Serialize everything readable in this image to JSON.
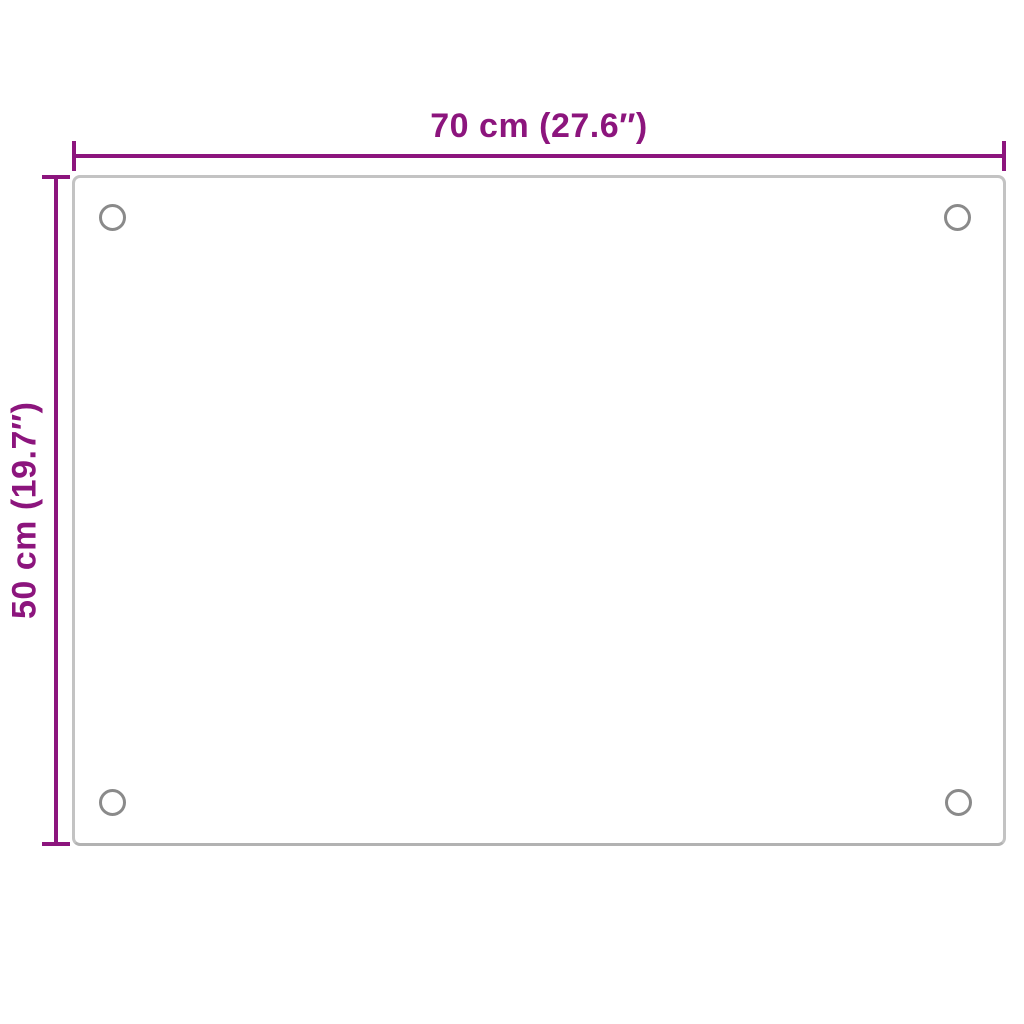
{
  "colors": {
    "dimension_accent": "#8c157d",
    "panel_border": "#c3c3c3",
    "hole_ring": "#8a8a8a",
    "background": "#ffffff"
  },
  "dimensions": {
    "width": {
      "label": "70 cm (27.6″)"
    },
    "height": {
      "label": "50 cm (19.7″)"
    }
  }
}
